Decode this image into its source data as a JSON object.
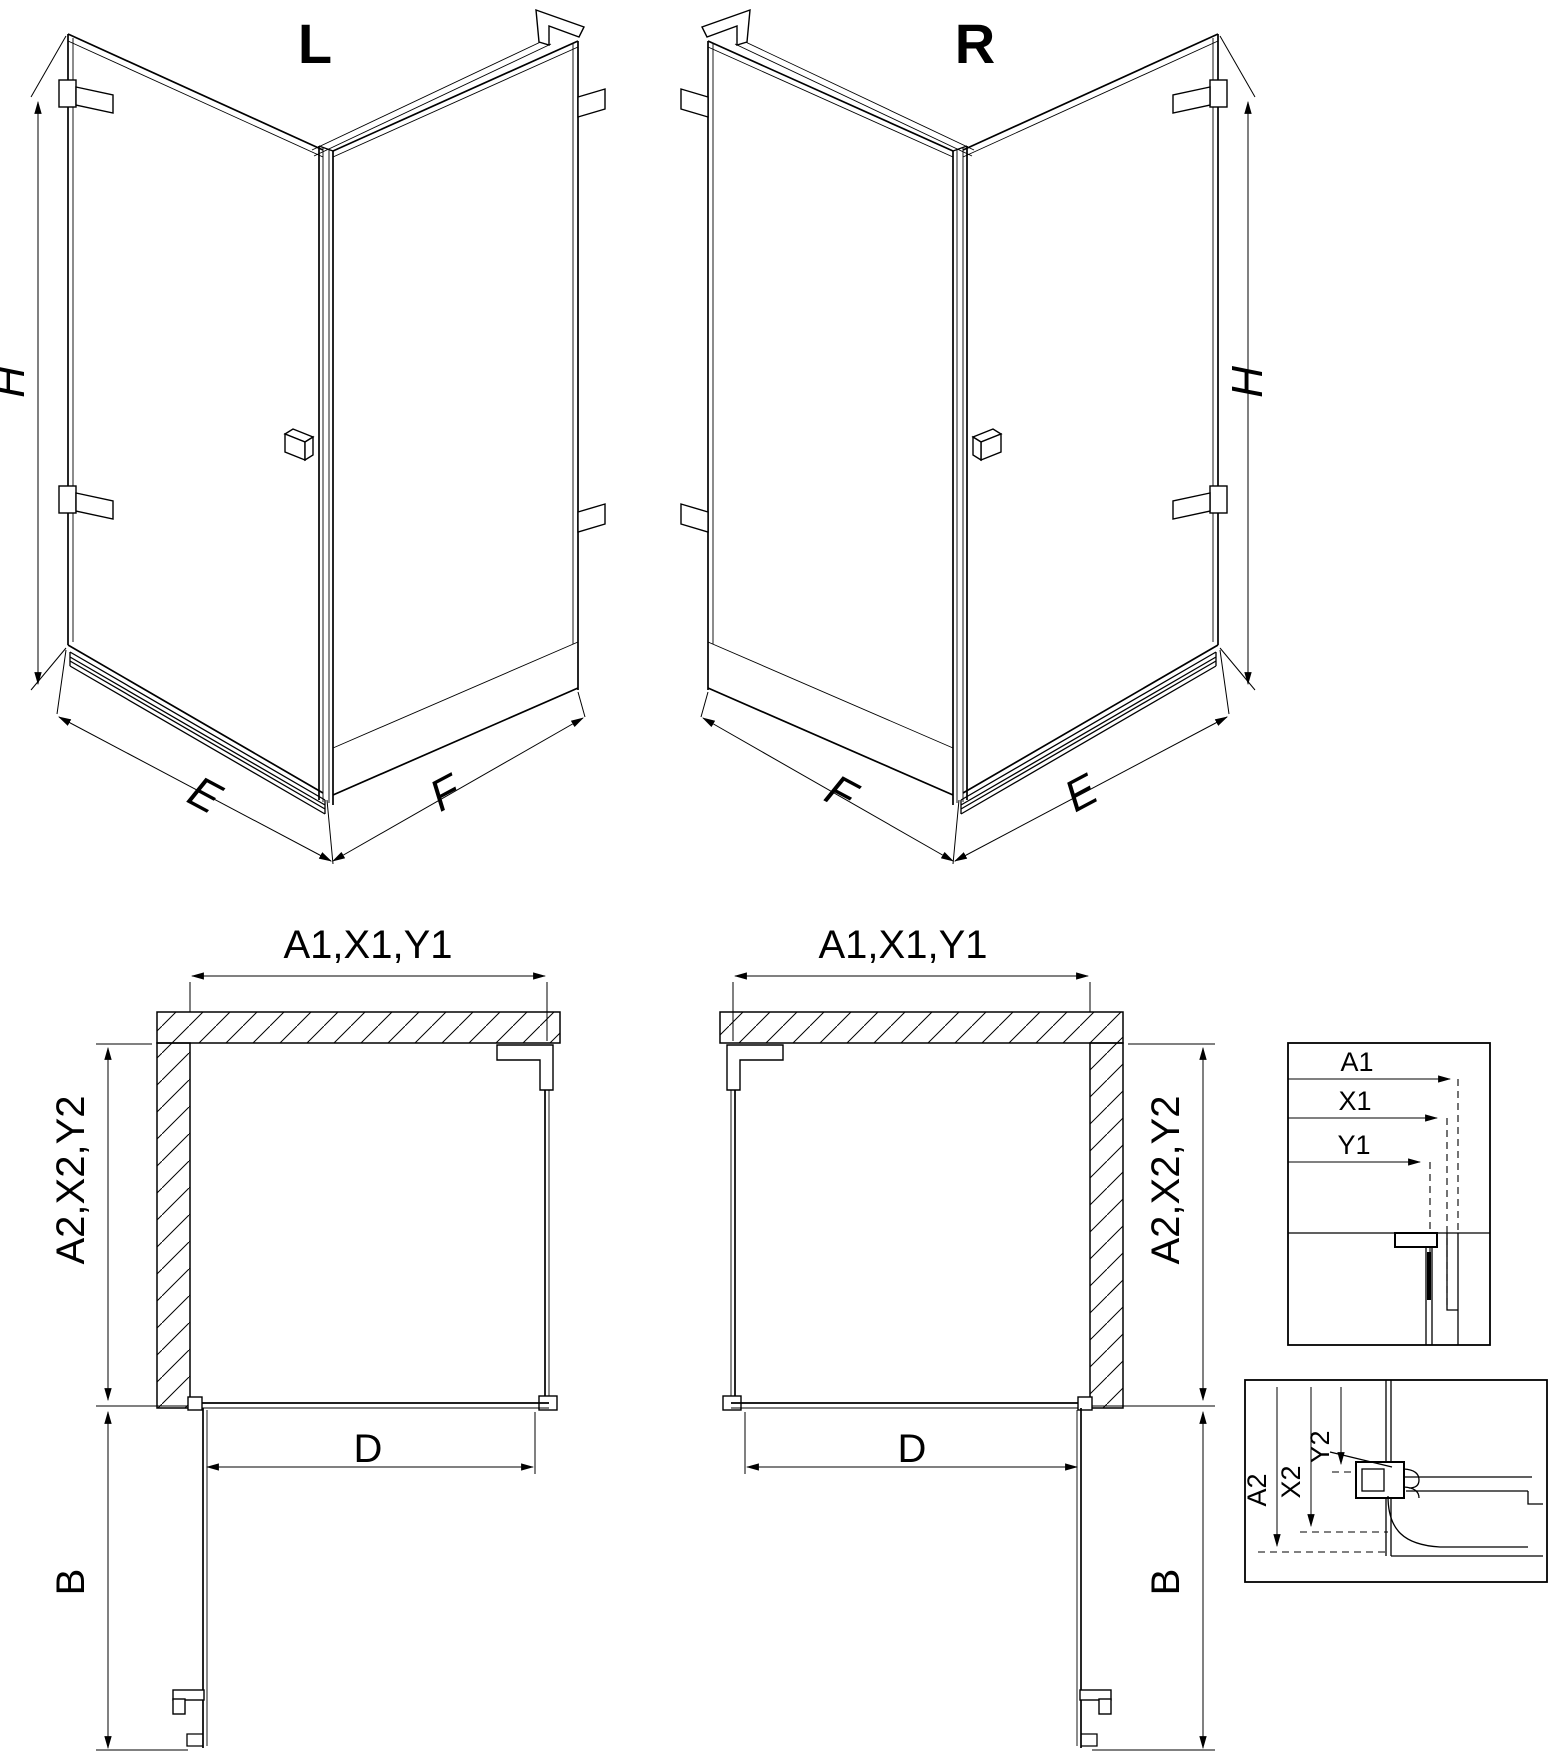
{
  "page": {
    "background": "#ffffff",
    "line_color": "#000000"
  },
  "iso_l": {
    "label": "L",
    "dim_height": "H",
    "dim_width_door": "E",
    "dim_width_fixed": "F"
  },
  "iso_r": {
    "label": "R",
    "dim_height": "H",
    "dim_width_door": "E",
    "dim_width_fixed": "F"
  },
  "plan_l": {
    "dim_top": "A1,X1,Y1",
    "dim_side": "A2,X2,Y2",
    "dim_door": "D",
    "dim_clearance": "B"
  },
  "plan_r": {
    "dim_top": "A1,X1,Y1",
    "dim_side": "A2,X2,Y2",
    "dim_door": "D",
    "dim_clearance": "B"
  },
  "detail_top": {
    "a1": "A1",
    "x1": "X1",
    "y1": "Y1"
  },
  "detail_bottom": {
    "a2": "A2",
    "x2": "X2",
    "y2": "Y2"
  }
}
